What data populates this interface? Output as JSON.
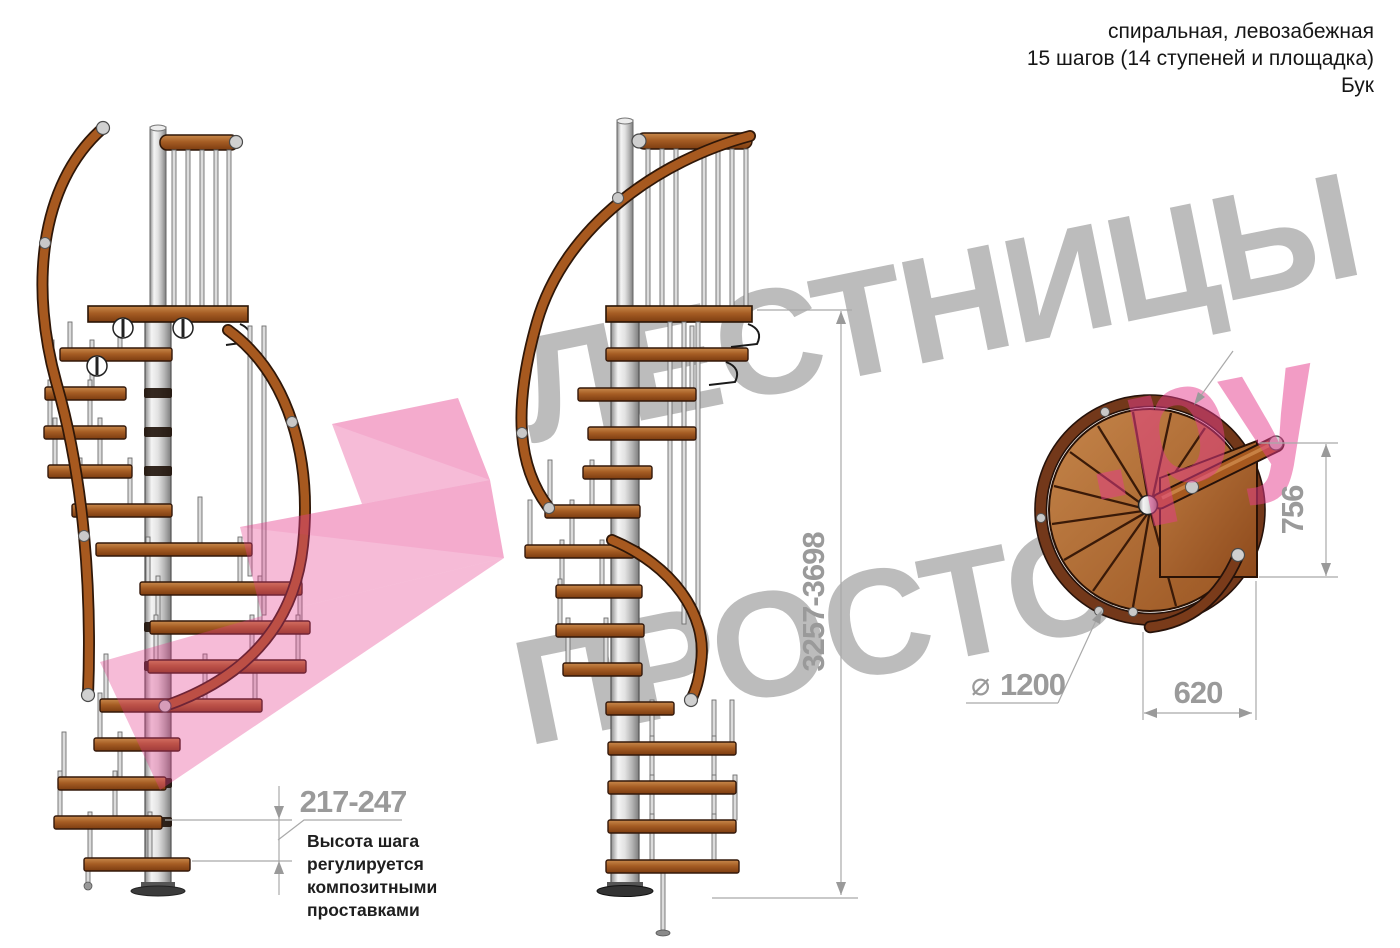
{
  "title_block": {
    "line1": "спиральная, левозабежная",
    "line2": "15 шагов (14 ступеней и площадка)",
    "line3": "Бук"
  },
  "dimensions": {
    "total_height": "3257-3698",
    "step_height": "217-247",
    "landing_depth": "756",
    "landing_width": "620",
    "diameter_symbol": "⌀",
    "diameter_value": "1200"
  },
  "step_note": {
    "line1": "Высота шага",
    "line2": "регулируется",
    "line3": "композитными",
    "line4": "проставками"
  },
  "watermark": {
    "word1": "ЛЕСТНИЦЫ",
    "word2": "ПРОСТО",
    "suffix": ".ру"
  },
  "colors": {
    "wood": "#a7591f",
    "wood_dark": "#2f1708",
    "metal": "#d9d9d9",
    "dimension_gray": "#9a9a9a",
    "watermark_gray": "#bcbcbc",
    "watermark_pink": "#e63c8c",
    "note_black": "#1e1e1e"
  }
}
